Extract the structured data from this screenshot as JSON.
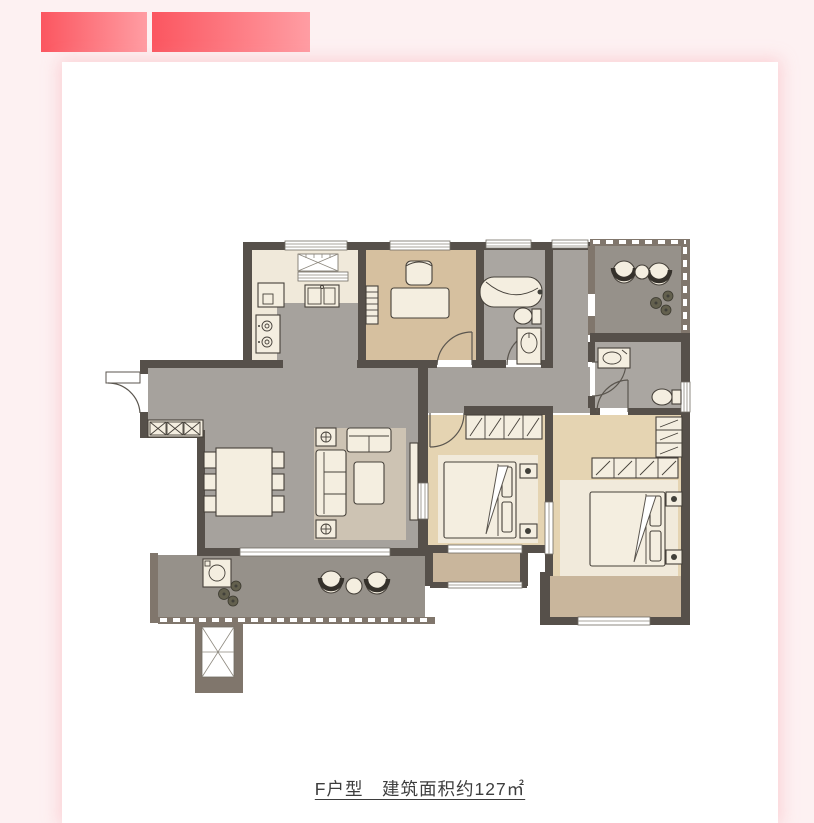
{
  "page": {
    "type": "article-page-with-floorplan"
  },
  "banner": {
    "segments": [
      {
        "name": "banner-segment-1"
      },
      {
        "name": "banner-segment-2"
      }
    ]
  },
  "floorplan": {
    "caption": "F户型　建筑面积约127㎡",
    "unit_type": "F户型",
    "area_text": "建筑面积约127㎡",
    "area_sqm": 127,
    "rooms": [
      "entry-hall",
      "kitchen",
      "study",
      "bathroom",
      "hallway",
      "leisure-balcony",
      "second-bathroom",
      "living-dining-room",
      "bedroom",
      "master-bedroom",
      "laundry-balcony",
      "duct-shaft"
    ],
    "furniture_icons": [
      "range-hood-flue",
      "kitchen-sink",
      "stove",
      "desk",
      "desk-chair",
      "bookshelf",
      "bathtub",
      "toilet",
      "washbasin",
      "lounge-chairs",
      "round-table",
      "plants",
      "shoe-cabinet",
      "dining-table",
      "dining-chairs",
      "sofa",
      "loveseat",
      "coffee-table",
      "side-tables",
      "tv-cabinet",
      "washing-machine",
      "wardrobe",
      "double-bed",
      "nightstands"
    ]
  },
  "palette": {
    "page_bg": "#fdf1f2",
    "card_bg": "#ffffff",
    "banner_start": "#fb5660",
    "banner_end": "#ff9da3",
    "wall_dark": "#56504a",
    "wall_brown": "#80766c",
    "floor_gray": "#a6a29d",
    "floor_kitchen": "#f0e9da",
    "floor_wood": "#d6c09f",
    "floor_wood_light": "#e5d4b2",
    "floor_bath": "#aaa6a1",
    "floor_balcony": "#96918a",
    "bay_tan": "#c9b69c",
    "rug": "#cdc3b3",
    "bed_rug": "#f1eadb",
    "furniture_cream": "#f4eee0",
    "furniture_outline": "#46413a",
    "caption_color": "#3d3d3d"
  }
}
